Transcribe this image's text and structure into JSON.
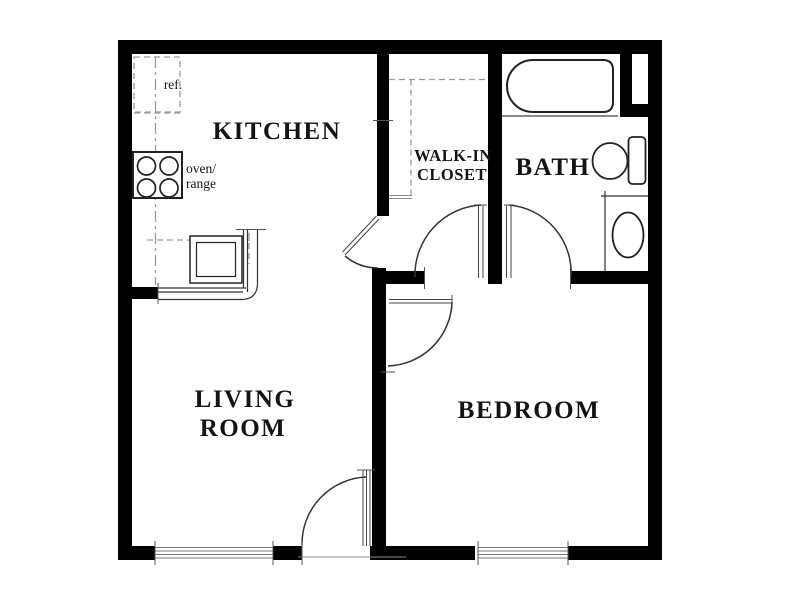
{
  "plan": {
    "type": "apartment-floor-plan",
    "rooms": {
      "kitchen": {
        "label": "KITCHEN"
      },
      "walk_in_closet": {
        "line1": "WALK-IN",
        "line2": "CLOSET"
      },
      "bath": {
        "label": "BATH"
      },
      "living_room": {
        "line1": "LIVING",
        "line2": "ROOM"
      },
      "bedroom": {
        "label": "BEDROOM"
      }
    },
    "fixtures": {
      "refrigerator": {
        "label": "ref."
      },
      "oven_range": {
        "line1": "oven/",
        "line2": "range"
      },
      "kitchen_sink": {
        "icon": "sink-icon"
      },
      "bathtub": {
        "icon": "bathtub-icon"
      },
      "toilet": {
        "icon": "toilet-icon"
      },
      "vanity_sink": {
        "icon": "vanity-sink-icon"
      },
      "windows": {
        "icon": "window-icon",
        "count": 2
      },
      "doors": {
        "icon": "door-swing-icon",
        "count": 5
      }
    },
    "colors": {
      "wall": "#000000",
      "fixture_line": "#222222",
      "thin_line": "#333333",
      "dashed_cabinet_line": "#9a9a9a",
      "background": "#ffffff"
    }
  }
}
